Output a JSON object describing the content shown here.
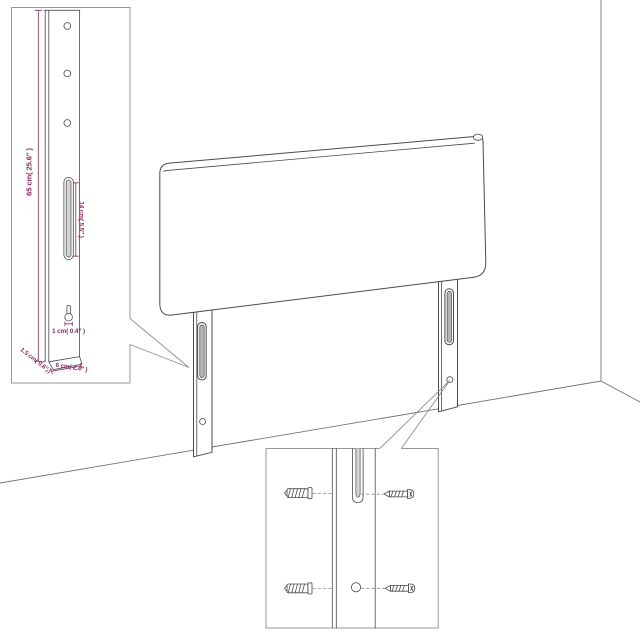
{
  "colors": {
    "background": "#ffffff",
    "drawing_line": "#4a4a4a",
    "wall_line": "#737373",
    "inset_border": "#989898",
    "dimension_text": "#8a2a5e",
    "slot_shading": "#b5b5b5"
  },
  "inset_leg_detail": {
    "height_label": "65 cm( 25.6″ )",
    "slot_label": "14 cm( 5.5″ )",
    "hole_label": "1 cm( 0.4″ )",
    "thickness_label": "1.5 cm( 0.6″ )",
    "width_label": "6 cm( 2.4″ )"
  }
}
